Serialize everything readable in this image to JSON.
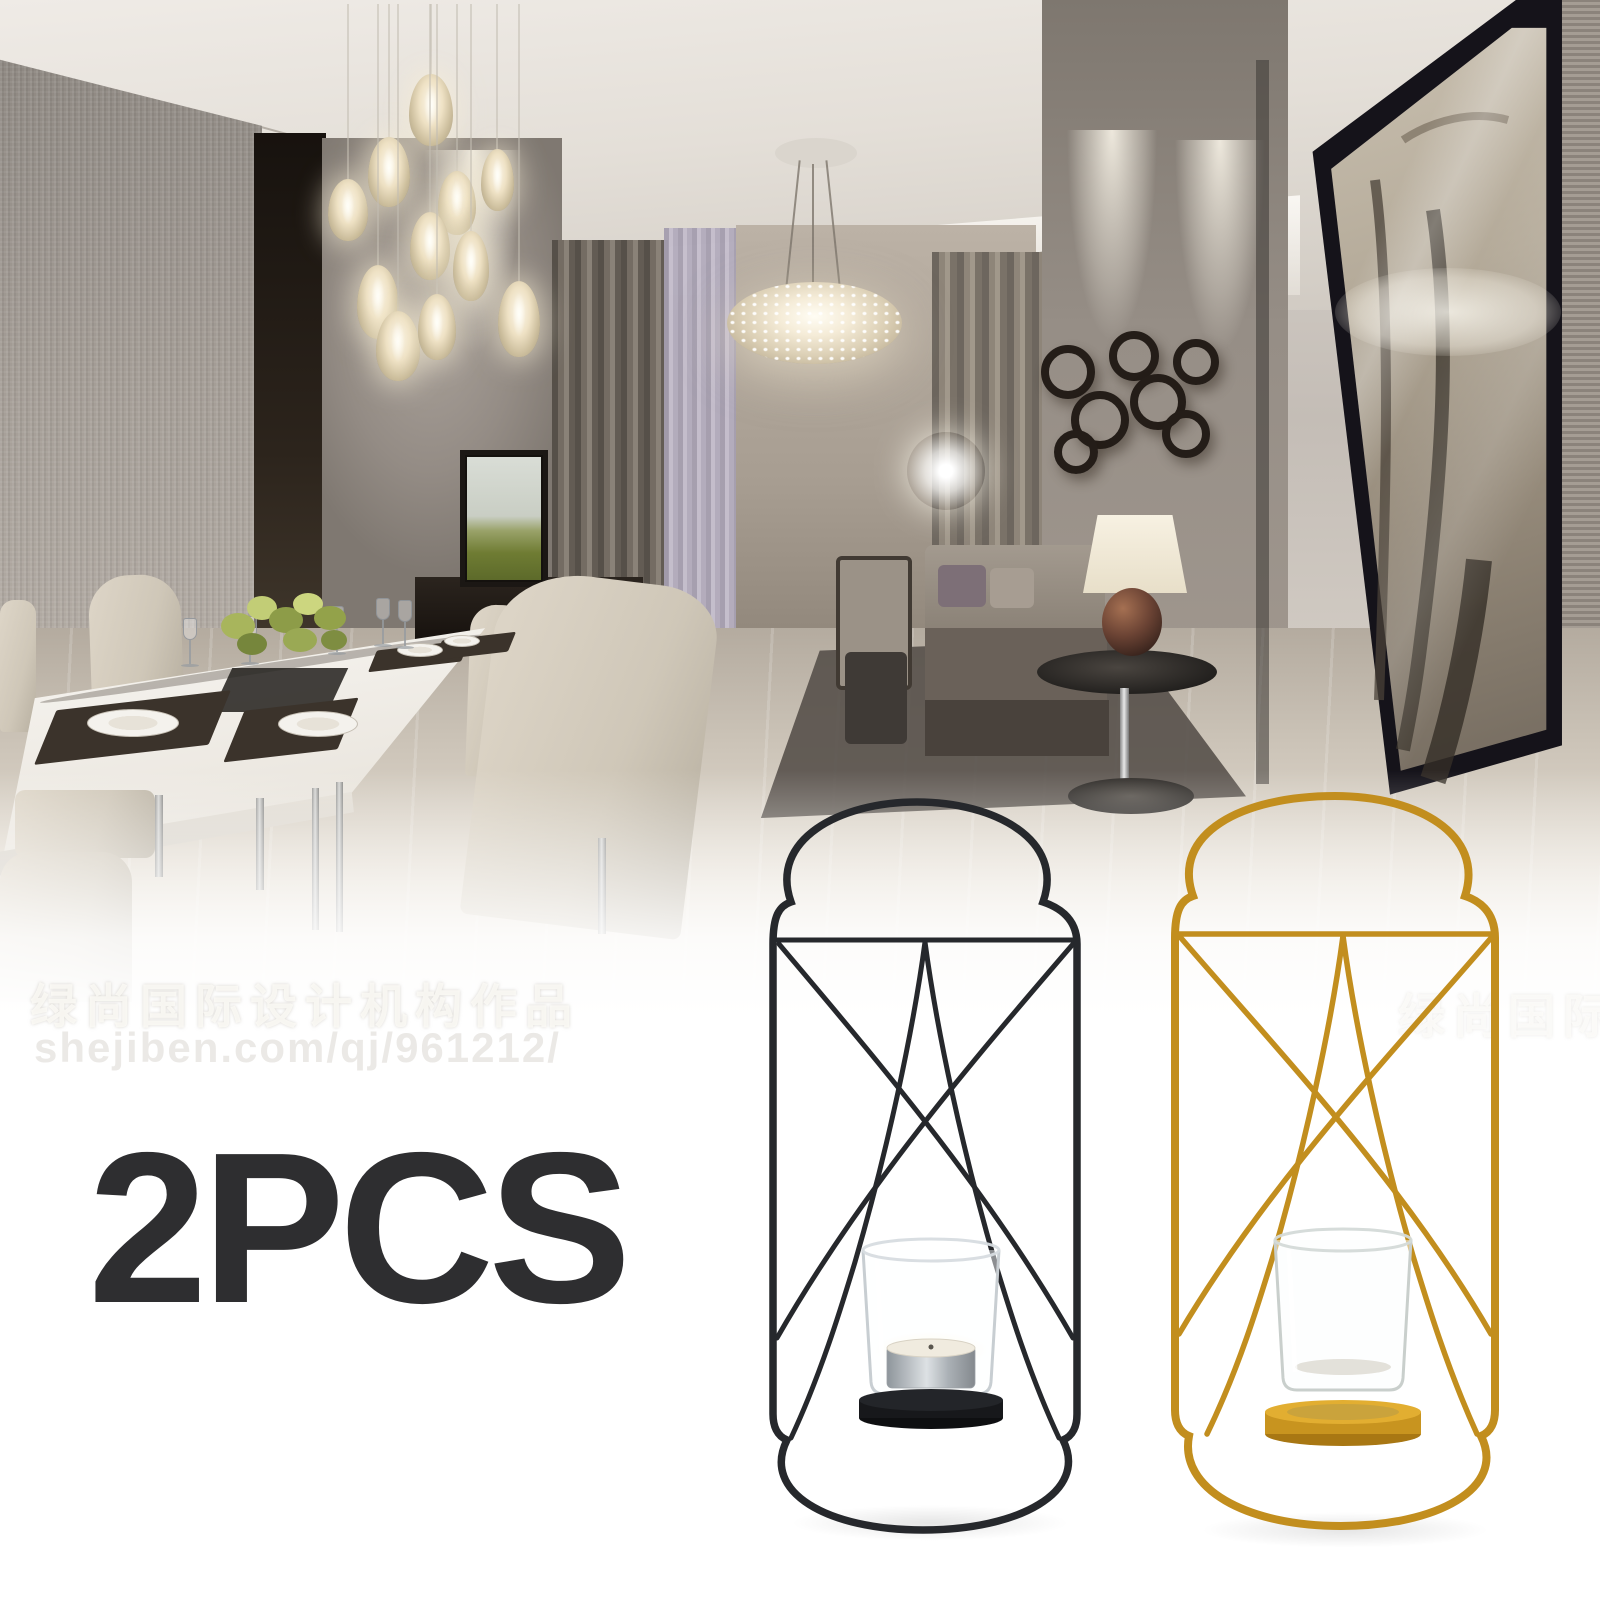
{
  "overlay": {
    "quantity_label": "2PCS"
  },
  "watermark": {
    "line1": "绿尚国际设计机构作品",
    "line2": "shejiben.com/qj/961212/"
  },
  "products": [
    {
      "name": "black wall-mounted wire candle sconce",
      "wire_color": "#26282c",
      "base_color": "#17181b",
      "glass_color": "#eef2f4",
      "tealight_color": "#c9ced2",
      "contents": "silver tealight candle in glass cup"
    },
    {
      "name": "gold wall-mounted wire candle sconce",
      "wire_color": "#c28e1e",
      "base_color": "#c8941f",
      "glass_color": "#f2f4f3",
      "contents": "empty glass cup"
    }
  ],
  "scene": {
    "elements": [
      "pendant-lights",
      "crystal-chandelier",
      "dining-table-set",
      "wall-tv",
      "curtains",
      "sofa-group",
      "table-lamp",
      "wall-ring-decor",
      "framed-botanical-art",
      "glossy-tile-floor"
    ]
  },
  "colors": {
    "background": "#ffffff",
    "quantity_text": "#2e2e30"
  }
}
